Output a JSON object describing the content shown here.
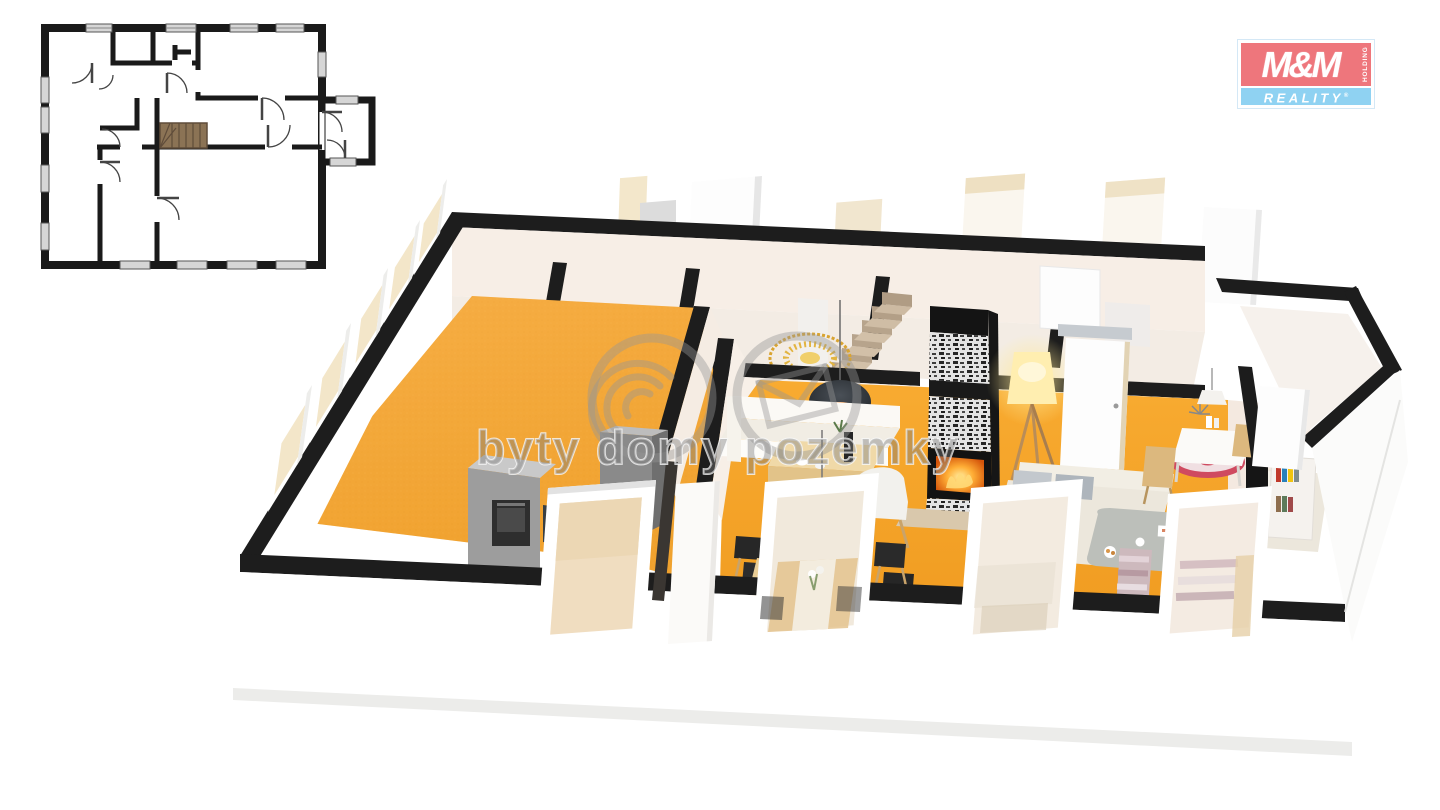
{
  "branding": {
    "logo": {
      "top_text": "M&M",
      "holding_text": "HOLDING",
      "bottom_text": "REALITY",
      "registered_mark": "®",
      "red": "#ee767c",
      "light_blue": "#8fd2f2",
      "text_color": "#ffffff"
    }
  },
  "watermark": {
    "text": "byty domy pozemky",
    "color": "rgba(128,128,128,0.45)",
    "icons": [
      "waves-circle-icon",
      "envelope-circle-icon"
    ]
  },
  "floor_plan_2d": {
    "kind": "2d-floor-plan-drawing",
    "wall_color": "#1a1a1a",
    "window_color": "#d6d6d6",
    "stairs_color": "#8b7355"
  },
  "floor_plan_3d": {
    "kind": "3d-isometric-floor-plan-render",
    "floor_color": "#f3a634",
    "wall_top_color": "#1d1d1d",
    "wall_color": "#ffffff",
    "visible_features": [
      "empty room with orange floor",
      "kitchen units with oven",
      "dining table with chairs and flowers",
      "white bench seating with wooden table",
      "stone fireplace with burning fire",
      "staircase",
      "glowing tripod floor lamp",
      "dark pendant lamp with candle glow",
      "gold sunburst wall decor",
      "beige sofas with coffee table",
      "desk with red round rug",
      "bookshelf with books",
      "white door panels and window frames"
    ]
  }
}
